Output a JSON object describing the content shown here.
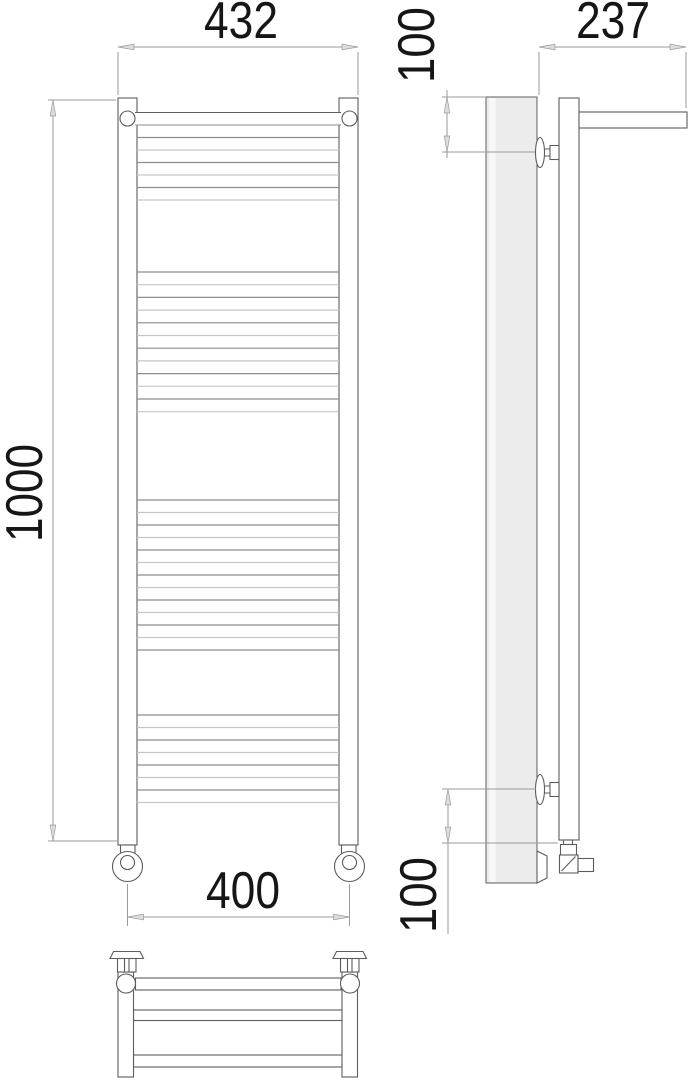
{
  "drawing": {
    "dimensions": {
      "overall_width": "432",
      "top_offset": "100",
      "depth": "237",
      "height": "1000",
      "bottom_width": "400",
      "bottom_offset": "100"
    },
    "colors": {
      "outline": "#5c5c5c",
      "dimension": "#9a9a9a",
      "arrow_fill": "#dcdcdc",
      "panel_fill": "#ececec",
      "panel_highlight": "#f8f8f8",
      "rung_dark": "#8e8e8e",
      "rung_light": "#c6c6c6",
      "text_color": "#161616"
    }
  }
}
